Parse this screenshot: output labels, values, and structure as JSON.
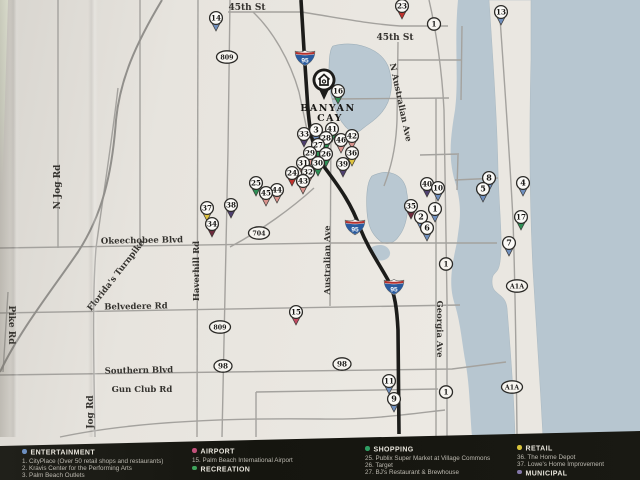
{
  "map": {
    "banyan": {
      "pin_icon": "home-icon",
      "label_line1": "BANYAN",
      "label_line2": "CAY",
      "x": 324,
      "y": 80
    },
    "road_labels": [
      {
        "t": "45th St",
        "x": 247,
        "y": 10,
        "r": 0
      },
      {
        "t": "45th St",
        "x": 395,
        "y": 40,
        "r": 0
      },
      {
        "t": "Okeechobee Blvd",
        "x": 142,
        "y": 243,
        "r": -1
      },
      {
        "t": "Belvedere Rd",
        "x": 136,
        "y": 309,
        "r": -1
      },
      {
        "t": "Southern Blvd",
        "x": 139,
        "y": 373,
        "r": -1
      },
      {
        "t": "Gun Club Rd",
        "x": 142,
        "y": 392,
        "r": 0
      },
      {
        "t": "N Jog Rd",
        "x": 60,
        "y": 187,
        "r": -90
      },
      {
        "t": "Jog Rd",
        "x": 93,
        "y": 412,
        "r": -90
      },
      {
        "t": "Haverhill Rd",
        "x": 199,
        "y": 271,
        "r": -90
      },
      {
        "t": "Pike Rd",
        "x": 9,
        "y": 325,
        "r": 90
      },
      {
        "t": "Florida's Turnpike",
        "x": 118,
        "y": 277,
        "r": -52
      },
      {
        "t": "N Australian Ave",
        "x": 398,
        "y": 103,
        "r": 78
      },
      {
        "t": "Australian Ave",
        "x": 330,
        "y": 260,
        "r": -90
      },
      {
        "t": "Georgia Ave",
        "x": 437,
        "y": 329,
        "r": 90
      }
    ],
    "shields": [
      {
        "type": "interstate",
        "t": "95",
        "x": 305,
        "y": 58
      },
      {
        "type": "interstate",
        "t": "95",
        "x": 355,
        "y": 227
      },
      {
        "type": "interstate",
        "t": "95",
        "x": 394,
        "y": 287
      },
      {
        "type": "oval",
        "t": "809",
        "x": 227,
        "y": 57
      },
      {
        "type": "oval",
        "t": "809",
        "x": 220,
        "y": 327
      },
      {
        "type": "oval",
        "t": "704",
        "x": 259,
        "y": 233
      },
      {
        "type": "oval",
        "t": "98",
        "x": 223,
        "y": 366
      },
      {
        "type": "oval",
        "t": "98",
        "x": 342,
        "y": 364
      },
      {
        "type": "oval",
        "t": "A1A",
        "x": 517,
        "y": 286
      },
      {
        "type": "oval",
        "t": "A1A",
        "x": 512,
        "y": 387
      },
      {
        "type": "circle",
        "t": "1",
        "x": 434,
        "y": 24
      },
      {
        "type": "circle",
        "t": "1",
        "x": 446,
        "y": 264
      },
      {
        "type": "circle",
        "t": "1",
        "x": 446,
        "y": 392
      }
    ],
    "marker_colors": {
      "blue": "#6f8fbe",
      "green": "#2e8f55",
      "salmon": "#d9928c",
      "red": "#c0322d",
      "pink": "#c24a62",
      "yellow": "#e0c43f",
      "purple": "#4f4070",
      "maroon": "#6e2a3c"
    },
    "markers": [
      {
        "n": "14",
        "x": 216,
        "y": 18,
        "c": "blue"
      },
      {
        "n": "23",
        "x": 402,
        "y": 6,
        "c": "red"
      },
      {
        "n": "13",
        "x": 501,
        "y": 12,
        "c": "blue"
      },
      {
        "n": "16",
        "x": 338,
        "y": 91,
        "c": "green"
      },
      {
        "n": "33",
        "x": 304,
        "y": 134,
        "c": "purple"
      },
      {
        "n": "3",
        "x": 316,
        "y": 130,
        "c": "blue"
      },
      {
        "n": "41",
        "x": 332,
        "y": 129,
        "c": "green"
      },
      {
        "n": "28",
        "x": 326,
        "y": 138,
        "c": "green"
      },
      {
        "n": "46",
        "x": 341,
        "y": 140,
        "c": "salmon"
      },
      {
        "n": "42",
        "x": 352,
        "y": 136,
        "c": "salmon"
      },
      {
        "n": "27",
        "x": 318,
        "y": 145,
        "c": "green"
      },
      {
        "n": "29",
        "x": 310,
        "y": 153,
        "c": "salmon"
      },
      {
        "n": "26",
        "x": 326,
        "y": 154,
        "c": "green"
      },
      {
        "n": "36",
        "x": 352,
        "y": 153,
        "c": "yellow"
      },
      {
        "n": "31",
        "x": 303,
        "y": 163,
        "c": "salmon"
      },
      {
        "n": "30",
        "x": 318,
        "y": 163,
        "c": "green"
      },
      {
        "n": "39",
        "x": 343,
        "y": 164,
        "c": "purple"
      },
      {
        "n": "32",
        "x": 308,
        "y": 172,
        "c": "salmon"
      },
      {
        "n": "24",
        "x": 292,
        "y": 173,
        "c": "red"
      },
      {
        "n": "43",
        "x": 303,
        "y": 181,
        "c": "salmon"
      },
      {
        "n": "25",
        "x": 256,
        "y": 183,
        "c": "green"
      },
      {
        "n": "44",
        "x": 277,
        "y": 190,
        "c": "salmon"
      },
      {
        "n": "45",
        "x": 266,
        "y": 193,
        "c": "salmon"
      },
      {
        "n": "37",
        "x": 207,
        "y": 208,
        "c": "yellow"
      },
      {
        "n": "38",
        "x": 231,
        "y": 205,
        "c": "purple"
      },
      {
        "n": "34",
        "x": 212,
        "y": 224,
        "c": "maroon"
      },
      {
        "n": "40",
        "x": 427,
        "y": 184,
        "c": "purple"
      },
      {
        "n": "10",
        "x": 438,
        "y": 188,
        "c": "blue"
      },
      {
        "n": "35",
        "x": 411,
        "y": 206,
        "c": "maroon"
      },
      {
        "n": "1",
        "x": 435,
        "y": 209,
        "c": "blue"
      },
      {
        "n": "2",
        "x": 421,
        "y": 217,
        "c": "blue"
      },
      {
        "n": "6",
        "x": 427,
        "y": 228,
        "c": "blue"
      },
      {
        "n": "8",
        "x": 489,
        "y": 178,
        "c": "blue"
      },
      {
        "n": "5",
        "x": 483,
        "y": 189,
        "c": "blue"
      },
      {
        "n": "4",
        "x": 523,
        "y": 183,
        "c": "blue"
      },
      {
        "n": "17",
        "x": 521,
        "y": 217,
        "c": "green"
      },
      {
        "n": "7",
        "x": 509,
        "y": 243,
        "c": "blue"
      },
      {
        "n": "15",
        "x": 296,
        "y": 312,
        "c": "pink"
      },
      {
        "n": "11",
        "x": 389,
        "y": 381,
        "c": "blue"
      },
      {
        "n": "9",
        "x": 394,
        "y": 399,
        "c": "blue"
      }
    ]
  },
  "legend": {
    "columns": [
      {
        "x": 22,
        "top": 449,
        "sections": [
          {
            "dot": "#6d8fc0",
            "title": "ENTERTAINMENT",
            "items": [
              "1. CityPlace (Over 50 retail shops and restaurants)",
              "2. Kravis Center for the Performing Arts",
              "3. Palm Beach Outlets"
            ]
          }
        ]
      },
      {
        "x": 192,
        "top": 448,
        "sections": [
          {
            "dot": "#c2507a",
            "title": "AIRPORT",
            "items": [
              "15. Palm Beach International Airport"
            ]
          },
          {
            "dot": "#3fa35c",
            "title": "RECREATION",
            "items": []
          }
        ]
      },
      {
        "x": 365,
        "top": 446,
        "sections": [
          {
            "dot": "#2f9e63",
            "title": "SHOPPING",
            "items": [
              "25. Publix Super Market at Village Commons",
              "26. Target",
              "27. BJ's Restaurant & Brewhouse"
            ]
          }
        ]
      },
      {
        "x": 517,
        "top": 445,
        "sections": [
          {
            "dot": "#d8c33b",
            "title": "RETAIL",
            "items": [
              "36. The Home Depot",
              "37. Lowe's Home Improvement"
            ]
          },
          {
            "dot": "#8377a8",
            "title": "MUNICIPAL",
            "items": []
          }
        ]
      }
    ]
  }
}
